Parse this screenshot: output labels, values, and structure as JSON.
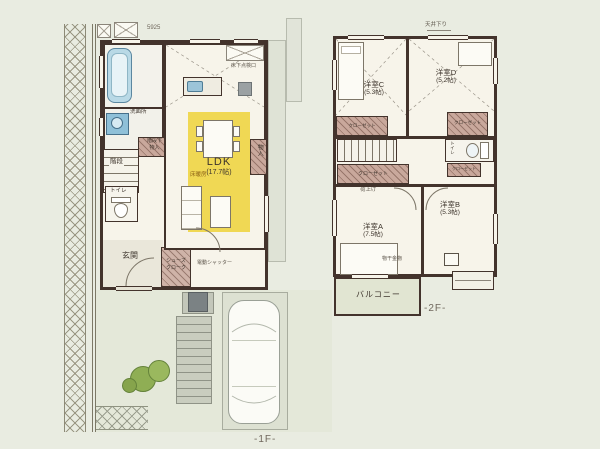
{
  "floor1": {
    "floor_label": "-1F-",
    "dim_top": "5925",
    "washroom": "洗面所",
    "stairs": "階段",
    "under_stairs_1": "階段下",
    "under_stairs_2": "物入",
    "toilet": "トイレ",
    "entrance": "玄関",
    "shoe_closet_1": "シューズ",
    "shoe_closet_2": "クローク",
    "ldk": "LDK",
    "ldk_size": "(17.7帖)",
    "floor_heating": "床暖房",
    "storage": "物入",
    "inspection": "床下点検口",
    "shutter": "電動シャッター"
  },
  "floor2": {
    "floor_label": "-2F-",
    "ceiling_drop": "天井下り",
    "room_c": "洋室C",
    "room_c_size": "(5.3帖)",
    "room_d": "洋室D",
    "room_d_size": "(5.2帖)",
    "room_a": "洋室A",
    "room_a_size": "(7.5帖)",
    "room_b": "洋室B",
    "room_b_size": "(5.3帖)",
    "closet": "クローゼット",
    "toilet": "トイレ",
    "hoist": "荷上げ",
    "laundry_hw": "物干金物",
    "balcony": "バルコニー"
  },
  "colors": {
    "wall": "#43332c",
    "ldk_yellow": "#f0d854",
    "closet_hatch": "#c9a89c",
    "bath_blue": "#b9d9e6",
    "greenery": "#8fae54",
    "background": "#e9ece1"
  }
}
